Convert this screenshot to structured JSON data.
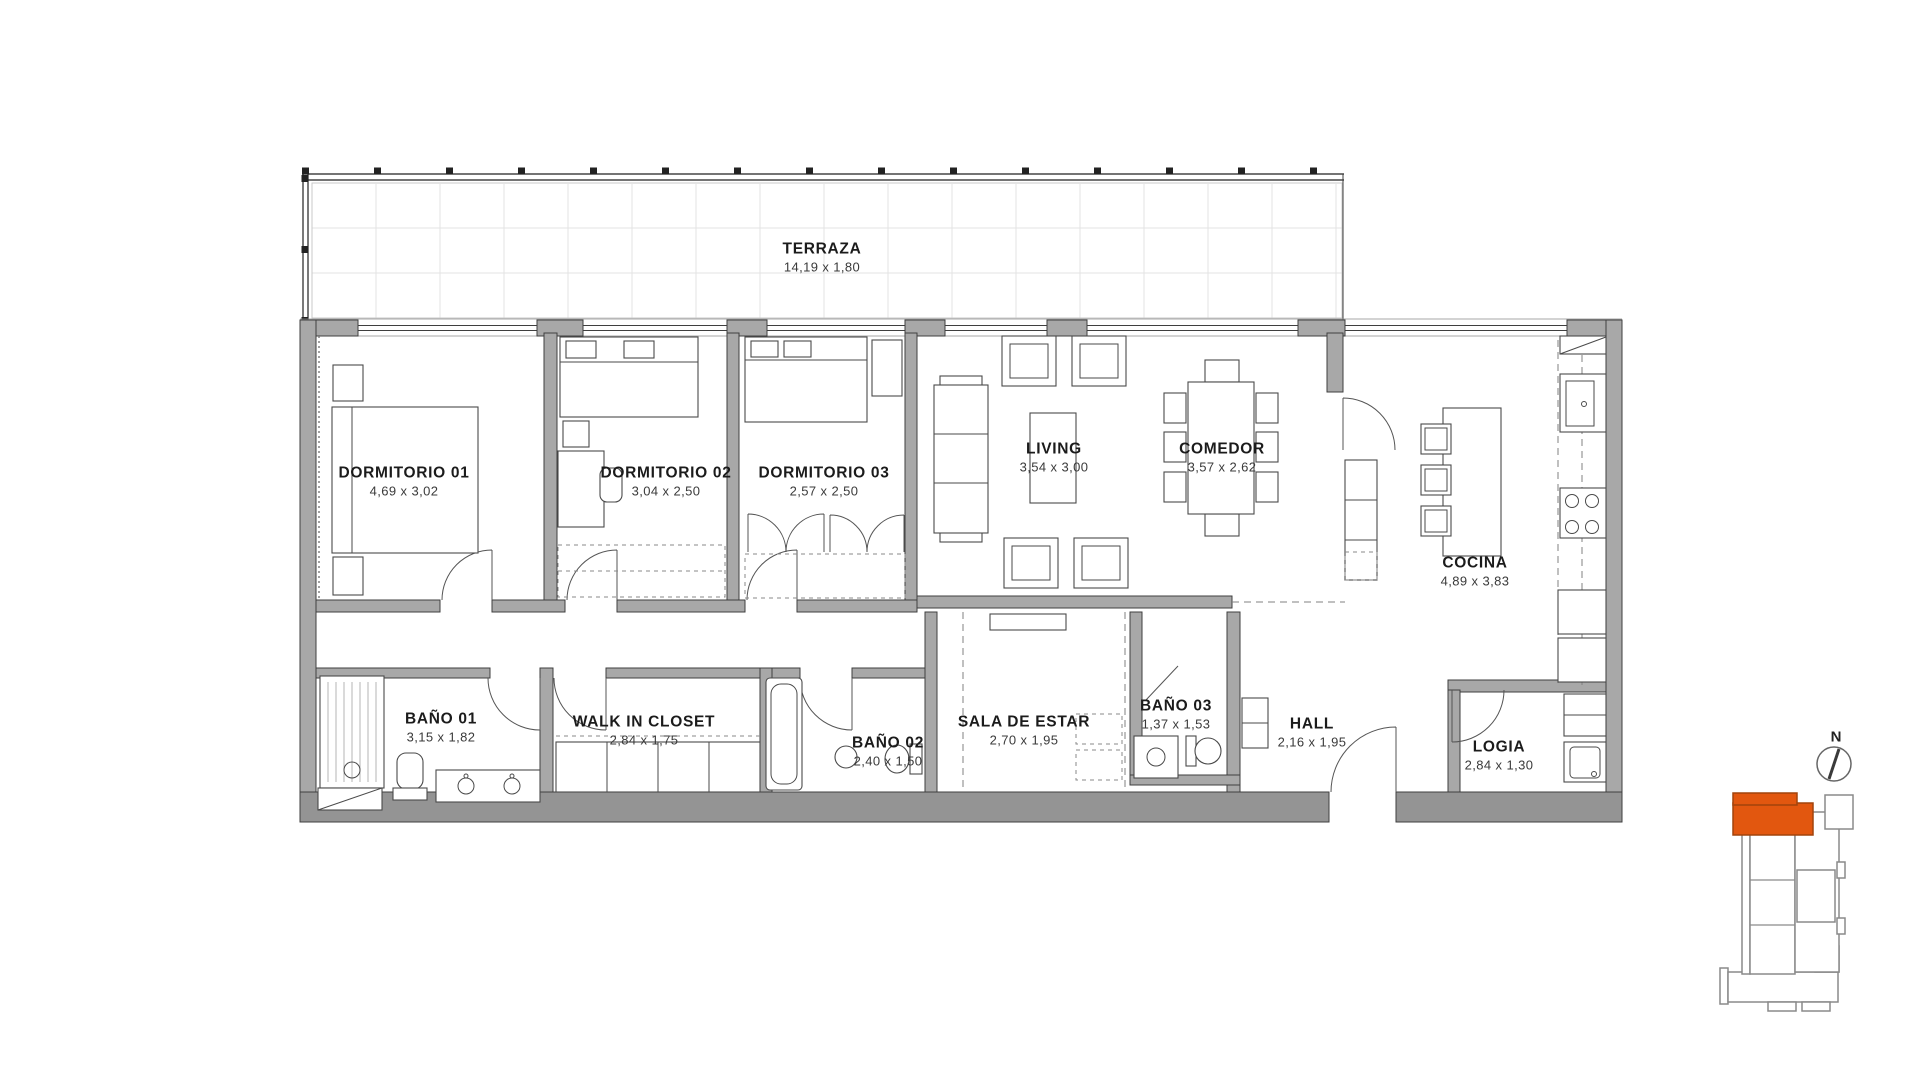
{
  "plan": {
    "rooms": [
      {
        "name": "TERRAZA",
        "dims": "14,19 x 1,80"
      },
      {
        "name": "DORMITORIO 01",
        "dims": "4,69 x 3,02"
      },
      {
        "name": "DORMITORIO 02",
        "dims": "3,04 x 2,50"
      },
      {
        "name": "DORMITORIO 03",
        "dims": "2,57 x 2,50"
      },
      {
        "name": "LIVING",
        "dims": "3,54 x 3,00"
      },
      {
        "name": "COMEDOR",
        "dims": "3,57 x 2,62"
      },
      {
        "name": "COCINA",
        "dims": "4,89 x 3,83"
      },
      {
        "name": "BAÑO 01",
        "dims": "3,15 x 1,82"
      },
      {
        "name": "WALK IN CLOSET",
        "dims": "2,84 x 1,75"
      },
      {
        "name": "BAÑO 02",
        "dims": "2,40 x 1,50"
      },
      {
        "name": "SALA DE ESTAR",
        "dims": "2,70 x 1,95"
      },
      {
        "name": "BAÑO 03",
        "dims": "1,37 x 1,53"
      },
      {
        "name": "HALL",
        "dims": "2,16 x 1,95"
      },
      {
        "name": "LOGIA",
        "dims": "2,84 x 1,30"
      }
    ],
    "key_plan": {
      "north_label": "N"
    },
    "colors": {
      "wall": "#a8a8a8",
      "wall_dark": "#949494",
      "line": "#3f3f3f",
      "accent": "#e2570f"
    }
  }
}
